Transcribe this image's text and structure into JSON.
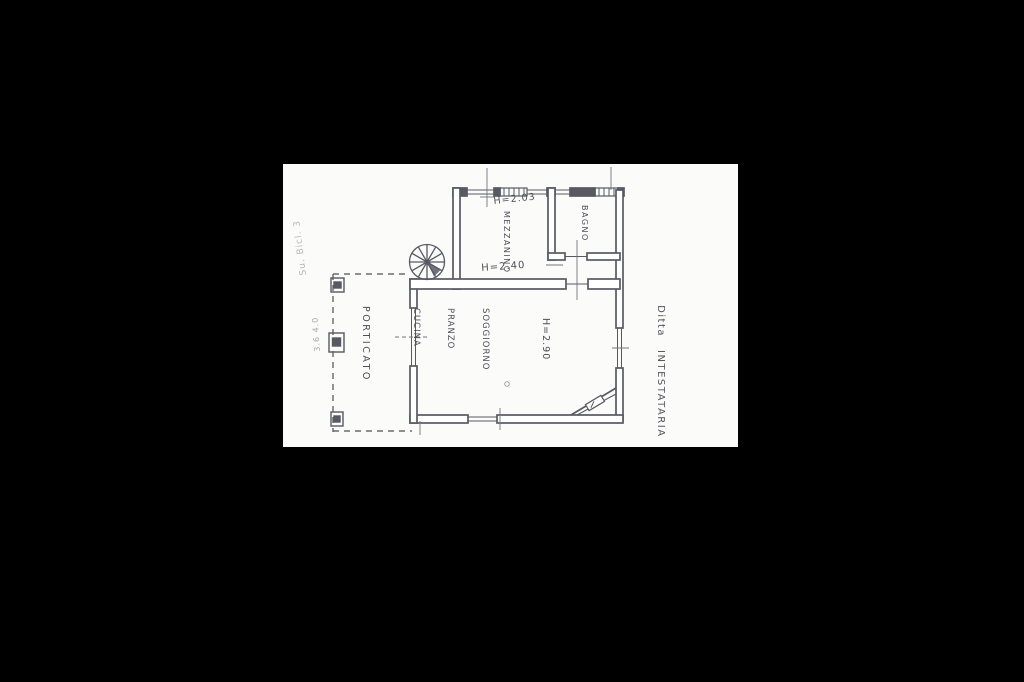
{
  "page": {
    "background": "#000000"
  },
  "paper": {
    "color": "#fbfbfa",
    "ink_color": "#585963"
  },
  "plan": {
    "type": "scanned cadastral floor plan",
    "labels": {
      "height_mezzanino": "H=2.03",
      "room_mezzanino": "MEZZANINO",
      "room_bagno": "BAGNO",
      "height_under_loft": "H=2.40",
      "room_main_line1": "SOGGIORNO",
      "room_main_line2": "PRANZO",
      "room_main_line3": "CUCINA",
      "height_main": "H=2.90",
      "room_porticato": "PORTICATO",
      "owner_word1": "Ditta",
      "owner_word2": "INTESTATARIA",
      "faint_note_top_left": "Su. Bicl. 3",
      "faint_note_left": "3.6 4.0"
    }
  }
}
